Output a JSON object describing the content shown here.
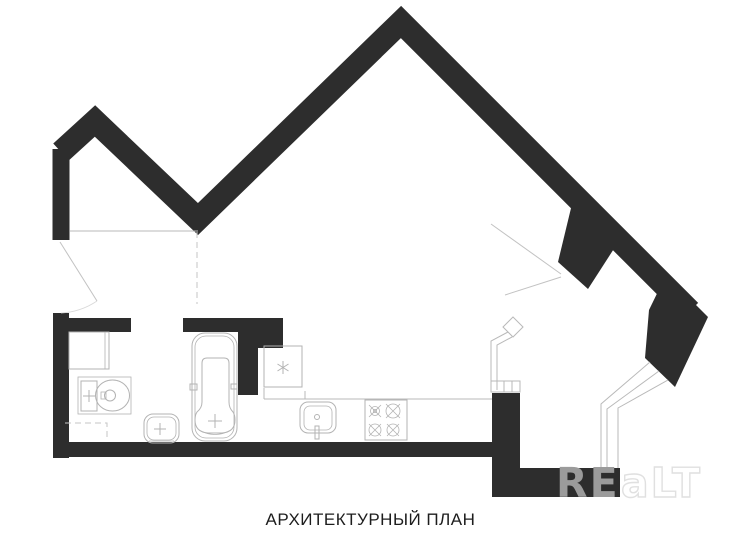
{
  "caption": "АРХИТЕКТУРНЫЙ ПЛАН",
  "watermark": {
    "solid_part": "RE",
    "outline_part": "aLT"
  },
  "colors": {
    "background": "#ffffff",
    "wall": "#2d2d2d",
    "thin_line": "#b9b9b9",
    "dashed_line": "#c6c6c6",
    "door_line": "#c2c2c2",
    "arc_line": "#d9d9d9",
    "fixture_line": "#b3b3b3",
    "caption_text": "#1d1d1d",
    "watermark_solid": "#9b9b9b",
    "watermark_outline": "#e0e0e0"
  },
  "icons": [
    "washing-machine-icon",
    "toilet-icon",
    "bathroom-sink-icon",
    "bathtub-icon",
    "refrigerator-snowflake-icon",
    "kitchen-sink-icon",
    "stove-burner-icon"
  ]
}
